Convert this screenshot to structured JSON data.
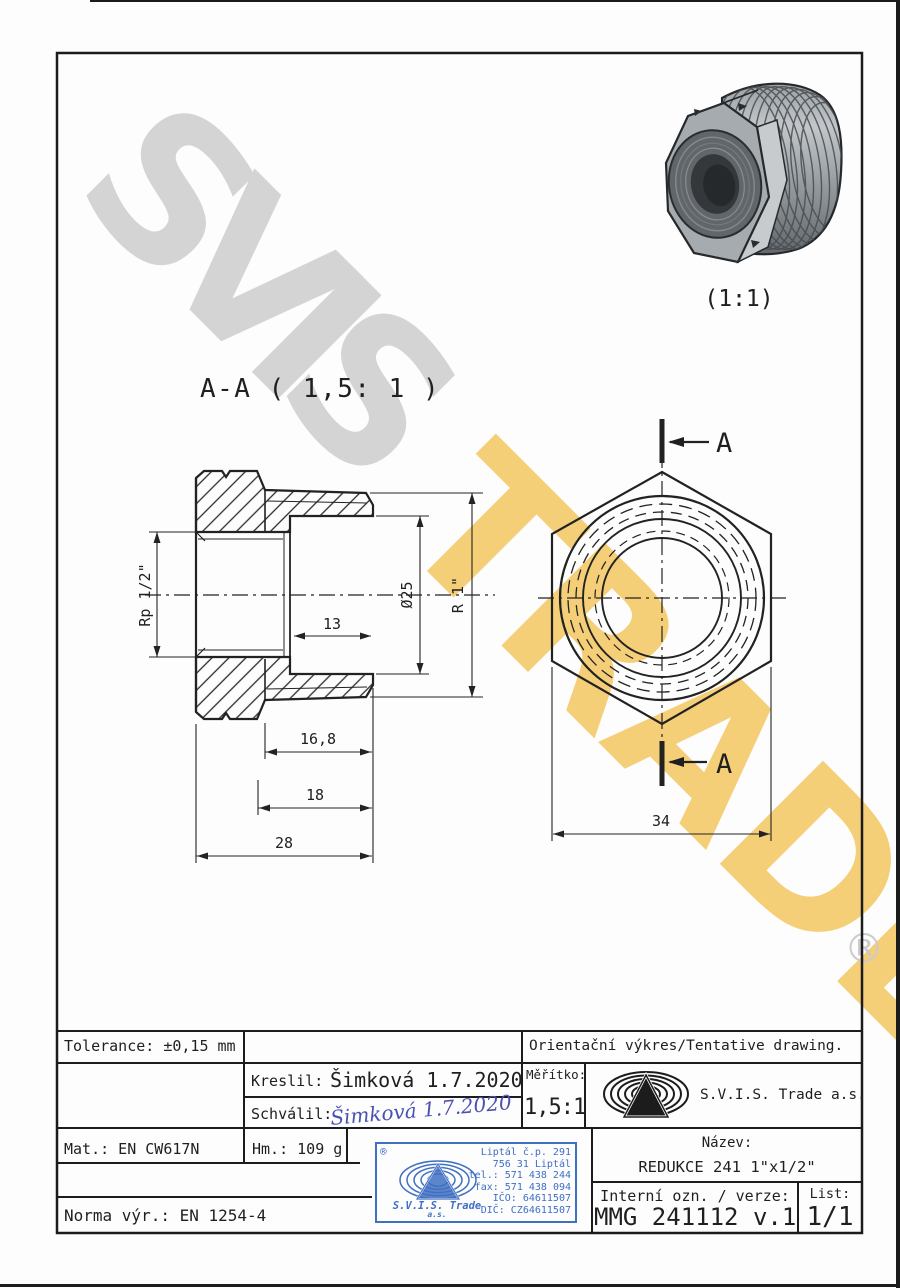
{
  "watermark": {
    "line1": "SVIS",
    "line2": "TRADE",
    "registered": "®",
    "gray": "#d4d4d4",
    "yellow": "#f4c45c"
  },
  "views": {
    "section_label": "A-A ( 1,5: 1 )",
    "scale_3d": "(1:1)",
    "arrow_letter": "A",
    "dims": {
      "rp": "Rp 1/2\"",
      "d25": "Ø25",
      "r1": "R 1\"",
      "d13": "13",
      "d168": "16,8",
      "d18": "18",
      "d28": "28",
      "d34": "34"
    }
  },
  "titleblock": {
    "tolerance": "Tolerance: ±0,15 mm",
    "orientacni": "Orientační výkres/Tentative drawing.",
    "kreslil_label": "Kreslil:",
    "kreslil_value": "Šimková 1.7.2020",
    "schvalil_label": "Schválil:",
    "schvalil_value": "Šimková 1.7.2020",
    "meritko_label": "Měřítko:",
    "meritko_value": "1,5:1",
    "company": "S.V.I.S. Trade a.s.",
    "mat": "Mat.: EN CW617N",
    "hm": "Hm.: 109 g",
    "norma": "Norma výr.: EN 1254-4",
    "nazev_label": "Název:",
    "nazev_value": "REDUKCE 241 1\"x1/2\"",
    "interni_label": "Interní ozn. / verze:",
    "interni_value": "MMG 241112 v.1",
    "list_label": "List:",
    "list_value": "1/1"
  },
  "stamp": {
    "reg": "®",
    "lines": [
      "Liptál č.p. 291",
      "756 31 Liptál",
      "tel.: 571 438 244",
      "fax: 571 438 094",
      "IČO: 64611507",
      "DIČ: CZ64611507"
    ],
    "company": "S.V.I.S. Trade",
    "suffix": "a.s.",
    "blue": "#3e6ec5"
  }
}
